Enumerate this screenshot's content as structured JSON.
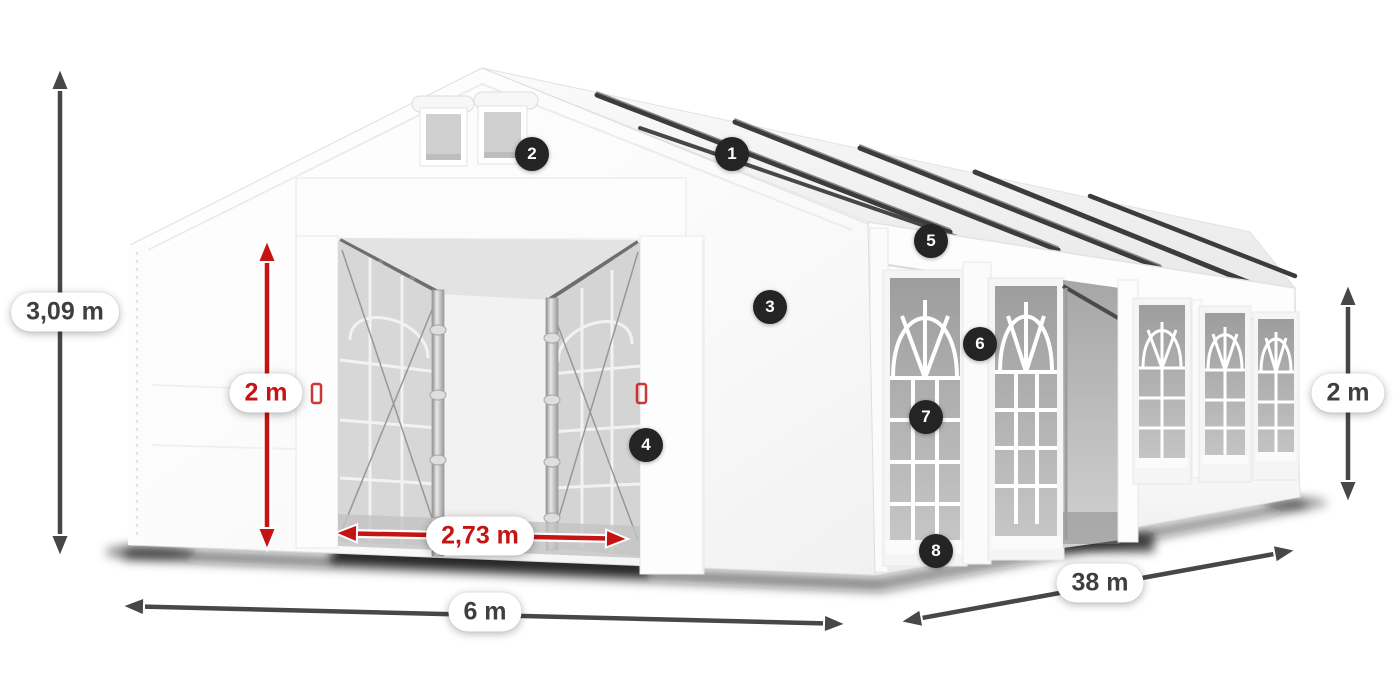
{
  "scene": {
    "kind": "product-dimension-diagram",
    "subject": "white party tent with windows",
    "marker_style": "dark numbered circles"
  },
  "dimension_labels": {
    "total_height": "3,09 m",
    "entrance_height": "2 m",
    "entrance_width": "2,73 m",
    "span_width": "6 m",
    "length": "38 m",
    "side_height": "2 m"
  },
  "markers": [
    {
      "number": "1"
    },
    {
      "number": "2"
    },
    {
      "number": "3"
    },
    {
      "number": "4"
    },
    {
      "number": "5"
    },
    {
      "number": "6"
    },
    {
      "number": "7"
    },
    {
      "number": "8"
    }
  ],
  "colors": {
    "dimension_red": "#c41414",
    "dimension_dark": "#474747",
    "marker_bg": "#242424",
    "marker_text": "#ffffff",
    "label_bg": "#ffffff",
    "label_text": "#3f3f3f"
  }
}
